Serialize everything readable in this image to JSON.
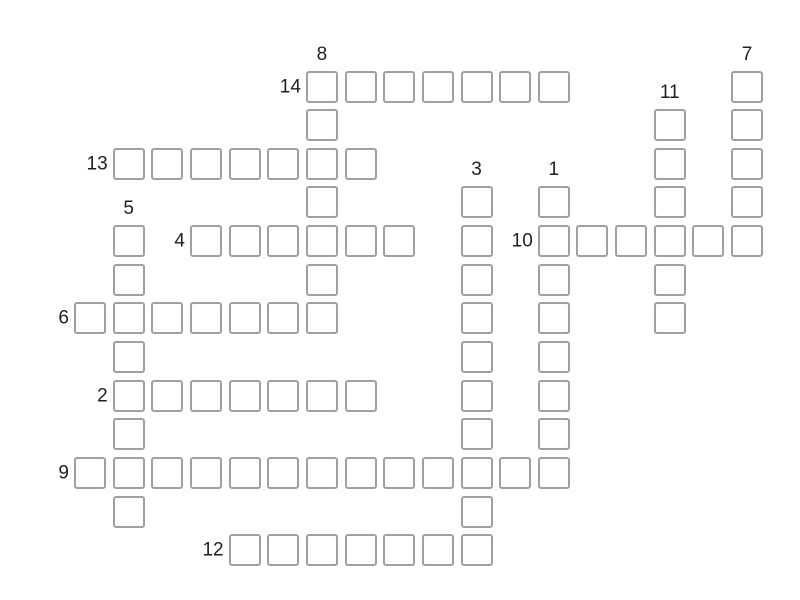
{
  "puzzle": {
    "type": "crossword",
    "background_color": "#ffffff",
    "cell_fill_color": "#ffffff",
    "cell_border_color": "#a0a0a0",
    "label_color": "#1f1f1f",
    "grid_rows": 13,
    "grid_cols": 18,
    "cells_empty": true,
    "entries": [
      {
        "number": "14",
        "direction": "across",
        "row": 0,
        "col": 6,
        "length": 7
      },
      {
        "number": "8",
        "direction": "down",
        "row": 0,
        "col": 6,
        "length": 7
      },
      {
        "number": "7",
        "direction": "down",
        "row": 0,
        "col": 17,
        "length": 5
      },
      {
        "number": "11",
        "direction": "down",
        "row": 1,
        "col": 15,
        "length": 6
      },
      {
        "number": "13",
        "direction": "across",
        "row": 2,
        "col": 1,
        "length": 7
      },
      {
        "number": "3",
        "direction": "down",
        "row": 3,
        "col": 10,
        "length": 10
      },
      {
        "number": "1",
        "direction": "down",
        "row": 3,
        "col": 12,
        "length": 8
      },
      {
        "number": "5",
        "direction": "down",
        "row": 4,
        "col": 1,
        "length": 8
      },
      {
        "number": "4",
        "direction": "across",
        "row": 4,
        "col": 3,
        "length": 6
      },
      {
        "number": "10",
        "direction": "across",
        "row": 4,
        "col": 12,
        "length": 6
      },
      {
        "number": "6",
        "direction": "across",
        "row": 6,
        "col": 0,
        "length": 7
      },
      {
        "number": "2",
        "direction": "across",
        "row": 8,
        "col": 1,
        "length": 7
      },
      {
        "number": "9",
        "direction": "across",
        "row": 10,
        "col": 0,
        "length": 13
      },
      {
        "number": "12",
        "direction": "across",
        "row": 12,
        "col": 4,
        "length": 7
      }
    ]
  }
}
